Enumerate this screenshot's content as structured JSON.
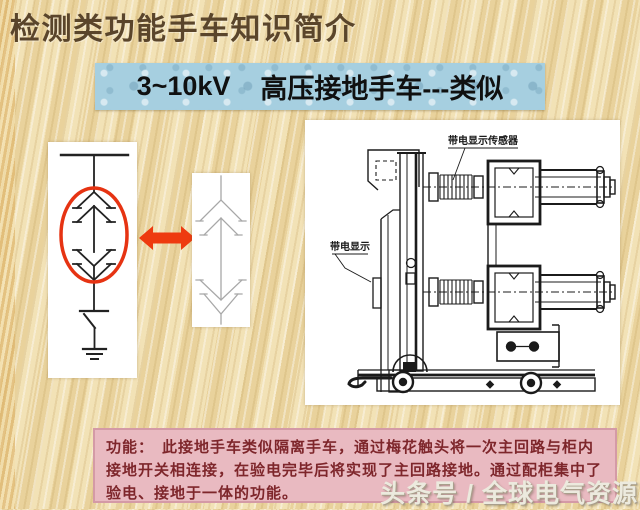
{
  "slide": {
    "title": "检测类功能手车知识简介",
    "banner": {
      "voltage": "3~10kV",
      "label": "高压接地手车---类似"
    }
  },
  "drawing": {
    "label_sensor": "带电显示传感器",
    "label_display": "带电显示"
  },
  "function_box": {
    "heading": "功能：",
    "text": "此接地手车类似隔离手车，通过梅花触头将一次主回路与柜内接地开关相连接，在验电完毕后将实现了主回路接地。通过配柜集中了验电、接地于一体的功能。"
  },
  "watermark": "头条号 / 全球电气资源",
  "colors": {
    "title-text": "#5a452b",
    "banner-bg": "#a6cfe0",
    "banner-text": "#101010",
    "function-bg": "#e9bac1",
    "function-text": "#7e262b",
    "highlight-red": "#e63312",
    "arrow-red": "#ee3a0f",
    "watermark": "#eceade"
  }
}
